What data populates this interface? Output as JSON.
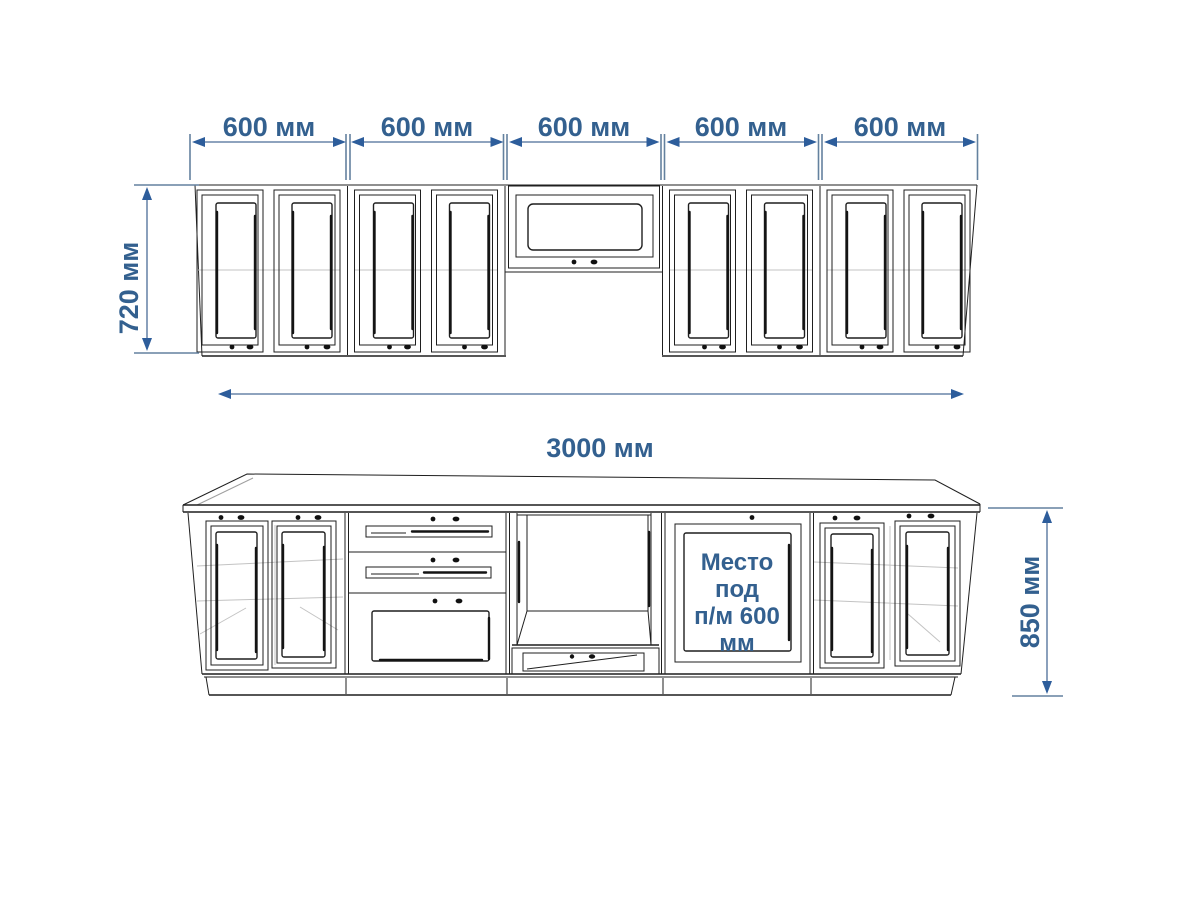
{
  "colors": {
    "background": "#ffffff",
    "drawing_line": "#1f1f1f",
    "hidden_line": "#c3c3c3",
    "dimension_line": "#7e96b4",
    "dimension_arrow": "#2d5d9b",
    "dimension_text": "#33608f"
  },
  "dimensions": {
    "upper_section_widths": [
      "600 мм",
      "600 мм",
      "600 мм",
      "600 мм",
      "600 мм"
    ],
    "upper_cabinet_height": "720 мм",
    "total_length": "3000 мм",
    "base_cabinet_height": "850 мм"
  },
  "labels": {
    "dishwasher_space": [
      "Место",
      "под",
      "п/м 600",
      "мм"
    ]
  }
}
